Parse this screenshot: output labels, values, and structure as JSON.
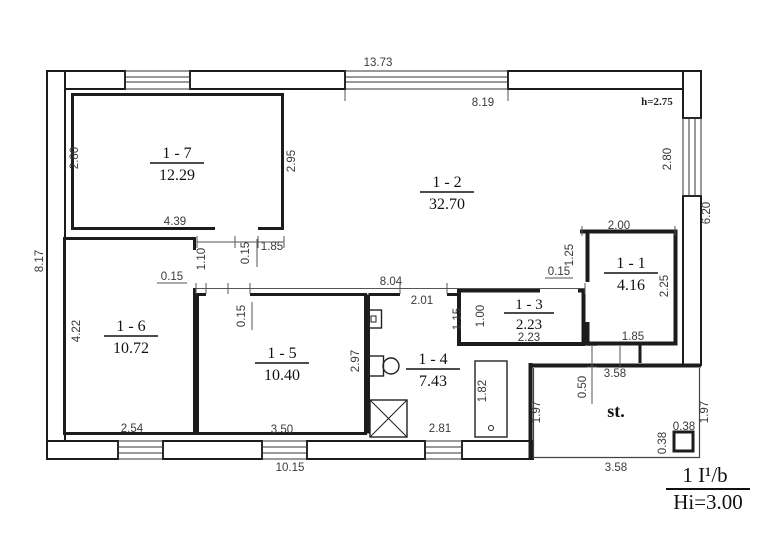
{
  "colors": {
    "ink": "#1c1c1c",
    "dim_text": "#3a3a3a",
    "background": "#ffffff"
  },
  "rooms": {
    "r1": {
      "label": "1 - 1",
      "area": "4.16"
    },
    "r2": {
      "label": "1 - 2",
      "area": "32.70"
    },
    "r3": {
      "label": "1 - 3",
      "area": "2.23"
    },
    "r4": {
      "label": "1 - 4",
      "area": "7.43"
    },
    "r5": {
      "label": "1 - 5",
      "area": "10.40"
    },
    "r6": {
      "label": "1 - 6",
      "area": "10.72"
    },
    "r7": {
      "label": "1 - 7",
      "area": "12.29"
    }
  },
  "dims": {
    "overall_top": "13.73",
    "window_top": "8.19",
    "height_note": "h=2.75",
    "window_right": "2.80",
    "side_right": "6.20",
    "side_left": "8.17",
    "r7_left": "2.80",
    "r7_right": "2.95",
    "r7_bottom": "4.39",
    "r7_door": "1.85",
    "corridor": "1.10",
    "wall_r6": "0.15",
    "wall_corridor": "0.15",
    "wall_r5": "0.15",
    "wall_r3": "0.15",
    "r6_left": "4.22",
    "r6_bottom": "2.54",
    "r5_right": "2.97",
    "r5_bottom": "3.50",
    "overall_bottom": "10.15",
    "hall_width": "8.04",
    "r4_door": "2.01",
    "r3_side_a": "1.15",
    "r3_side_b": "1.00",
    "r3_bottom": "2.23",
    "tub": "1.82",
    "r4_bottom": "2.81",
    "r1_left": "1.25",
    "r1_top": "2.00",
    "r1_right": "2.25",
    "r1_bottom": "1.85",
    "porch_top": "3.58",
    "porch_step": "0.50",
    "porch_left": "1.97",
    "porch_right": "1.97",
    "pillar_w": "0.38",
    "pillar_h": "0.38",
    "porch_bottom": "3.58"
  },
  "annotations": {
    "stairs": "st.",
    "plan_code": "1 I¹/b",
    "floor_height": "Hi=3.00"
  }
}
